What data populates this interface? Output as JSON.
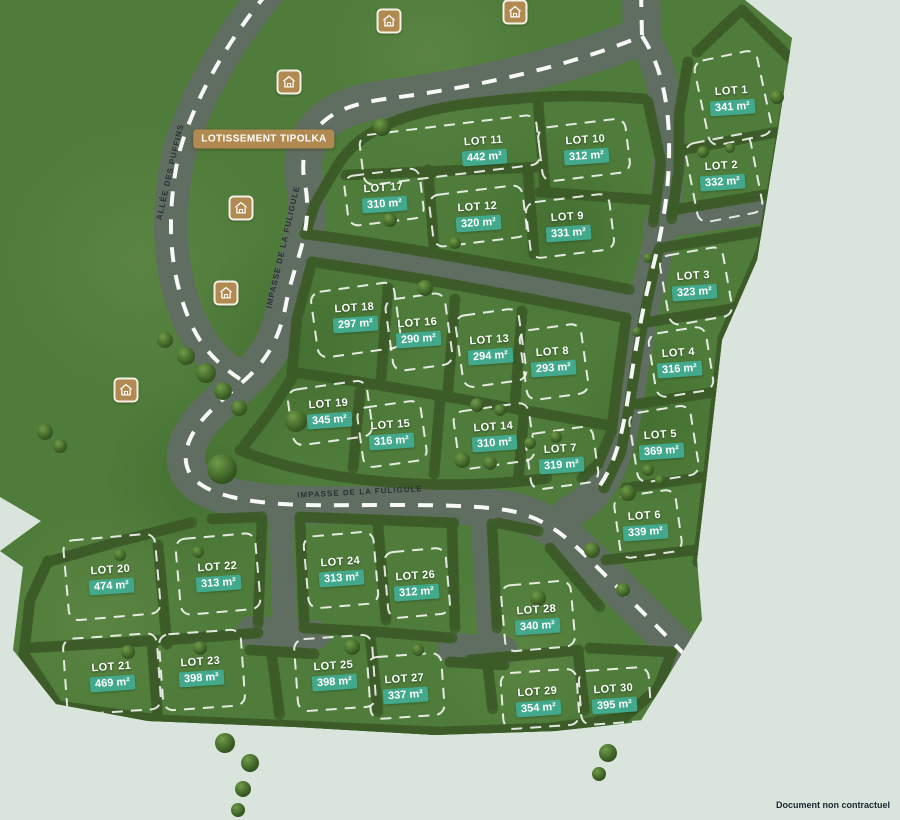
{
  "map": {
    "banner": {
      "text": "LOTISSEMENT TIPOLKA",
      "x": 264,
      "y": 139
    },
    "disclaimer": {
      "text": "Document non contractuel"
    },
    "streets": [
      {
        "name": "ALLÉE DES PUFFINS",
        "x": 170,
        "y": 172,
        "rotation": -77
      },
      {
        "name": "IMPASSE DE LA FULIGULE",
        "x": 283,
        "y": 247,
        "rotation": -77
      },
      {
        "name": "IMPASSE DE LA FULIGULE",
        "x": 360,
        "y": 492,
        "rotation": -3
      }
    ],
    "lots": [
      {
        "id": 1,
        "label": "LOT 1",
        "area": "341 m²",
        "x": 732,
        "y": 93,
        "box": [
          733,
          98,
          64,
          86,
          -12
        ]
      },
      {
        "id": 2,
        "label": "LOT 2",
        "area": "332 m²",
        "x": 722,
        "y": 168,
        "box": [
          724,
          178,
          66,
          80,
          -11
        ]
      },
      {
        "id": 3,
        "label": "LOT 3",
        "area": "323 m²",
        "x": 694,
        "y": 278,
        "box": [
          696,
          286,
          64,
          70,
          -10
        ]
      },
      {
        "id": 4,
        "label": "LOT 4",
        "area": "316 m²",
        "x": 679,
        "y": 355,
        "box": [
          681,
          362,
          58,
          64,
          -9
        ]
      },
      {
        "id": 5,
        "label": "LOT 5",
        "area": "369 m²",
        "x": 661,
        "y": 437,
        "box": [
          664,
          444,
          62,
          70,
          -9
        ]
      },
      {
        "id": 6,
        "label": "LOT 6",
        "area": "339 m²",
        "x": 645,
        "y": 518,
        "box": [
          648,
          524,
          62,
          62,
          -8
        ]
      },
      {
        "id": 7,
        "label": "LOT 7",
        "area": "319 m²",
        "x": 561,
        "y": 451,
        "box": [
          562,
          458,
          68,
          56,
          -8
        ]
      },
      {
        "id": 8,
        "label": "LOT 8",
        "area": "293 m²",
        "x": 553,
        "y": 354,
        "box": [
          554,
          362,
          62,
          70,
          -8
        ]
      },
      {
        "id": 9,
        "label": "LOT 9",
        "area": "331 m²",
        "x": 568,
        "y": 219,
        "box": [
          570,
          226,
          84,
          56,
          -7
        ]
      },
      {
        "id": 10,
        "label": "LOT 10",
        "area": "312 m²",
        "x": 586,
        "y": 142,
        "box": [
          584,
          150,
          88,
          54,
          -7
        ]
      },
      {
        "id": 11,
        "label": "LOT 11",
        "area": "442 m²",
        "x": 484,
        "y": 143,
        "box": [
          450,
          150,
          178,
          50,
          -7
        ]
      },
      {
        "id": 12,
        "label": "LOT 12",
        "area": "320 m²",
        "x": 478,
        "y": 209,
        "box": [
          478,
          216,
          94,
          52,
          -7
        ]
      },
      {
        "id": 13,
        "label": "LOT 13",
        "area": "294 m²",
        "x": 490,
        "y": 342,
        "box": [
          491,
          348,
          64,
          72,
          -8
        ]
      },
      {
        "id": 14,
        "label": "LOT 14",
        "area": "310 m²",
        "x": 494,
        "y": 429,
        "box": [
          494,
          436,
          76,
          58,
          -8
        ]
      },
      {
        "id": 15,
        "label": "LOT 15",
        "area": "316 m²",
        "x": 391,
        "y": 427,
        "box": [
          392,
          434,
          64,
          60,
          -8
        ]
      },
      {
        "id": 16,
        "label": "LOT 16",
        "area": "290 m²",
        "x": 418,
        "y": 325,
        "box": [
          419,
          332,
          60,
          72,
          -8
        ]
      },
      {
        "id": 17,
        "label": "LOT 17",
        "area": "310 m²",
        "x": 384,
        "y": 190,
        "box": [
          384,
          197,
          76,
          50,
          -7
        ]
      },
      {
        "id": 18,
        "label": "LOT 18",
        "area": "297 m²",
        "x": 355,
        "y": 310,
        "box": [
          356,
          320,
          84,
          66,
          -8
        ]
      },
      {
        "id": 19,
        "label": "LOT 19",
        "area": "345 m²",
        "x": 329,
        "y": 406,
        "box": [
          330,
          413,
          80,
          56,
          -8
        ]
      },
      {
        "id": 20,
        "label": "LOT 20",
        "area": "474 m²",
        "x": 111,
        "y": 572,
        "box": [
          112,
          577,
          92,
          80,
          -5
        ]
      },
      {
        "id": 21,
        "label": "LOT 21",
        "area": "469 m²",
        "x": 112,
        "y": 669,
        "box": [
          112,
          674,
          94,
          76,
          -4
        ]
      },
      {
        "id": 22,
        "label": "LOT 22",
        "area": "313 m²",
        "x": 218,
        "y": 569,
        "box": [
          218,
          574,
          80,
          76,
          -5
        ]
      },
      {
        "id": 23,
        "label": "LOT 23",
        "area": "398 m²",
        "x": 201,
        "y": 664,
        "box": [
          202,
          670,
          82,
          76,
          -4
        ]
      },
      {
        "id": 24,
        "label": "LOT 24",
        "area": "313 m²",
        "x": 341,
        "y": 564,
        "box": [
          341,
          570,
          70,
          72,
          -5
        ]
      },
      {
        "id": 25,
        "label": "LOT 25",
        "area": "398 m²",
        "x": 334,
        "y": 668,
        "box": [
          335,
          673,
          78,
          72,
          -4
        ]
      },
      {
        "id": 26,
        "label": "LOT 26",
        "area": "312 m²",
        "x": 416,
        "y": 578,
        "box": [
          417,
          583,
          62,
          66,
          -5
        ]
      },
      {
        "id": 27,
        "label": "LOT 27",
        "area": "337 m²",
        "x": 405,
        "y": 681,
        "box": [
          406,
          686,
          74,
          62,
          -4
        ]
      },
      {
        "id": 28,
        "label": "LOT 28",
        "area": "340 m²",
        "x": 537,
        "y": 612,
        "box": [
          538,
          616,
          70,
          66,
          -5
        ]
      },
      {
        "id": 29,
        "label": "LOT 29",
        "area": "354 m²",
        "x": 538,
        "y": 694,
        "box": [
          540,
          699,
          76,
          56,
          -4
        ]
      },
      {
        "id": 30,
        "label": "LOT 30",
        "area": "395 m²",
        "x": 614,
        "y": 691,
        "box": [
          615,
          696,
          70,
          54,
          -4
        ]
      }
    ],
    "house_icons": [
      {
        "name": "house-icon",
        "x": 389,
        "y": 21
      },
      {
        "name": "house-icon",
        "x": 515,
        "y": 12
      },
      {
        "name": "house-icon",
        "x": 289,
        "y": 82
      },
      {
        "name": "house-icon",
        "x": 241,
        "y": 208
      },
      {
        "name": "house-icon",
        "x": 226,
        "y": 293
      },
      {
        "name": "house-icon",
        "x": 126,
        "y": 390
      }
    ],
    "colors": {
      "background": "#d9e5dc",
      "grass": "#72a854",
      "road": "#8e9295",
      "hedge": "#3c5c28",
      "lot_chip": "#42a98c",
      "banner": "#b08a50",
      "street_text": "#2a3138"
    }
  }
}
